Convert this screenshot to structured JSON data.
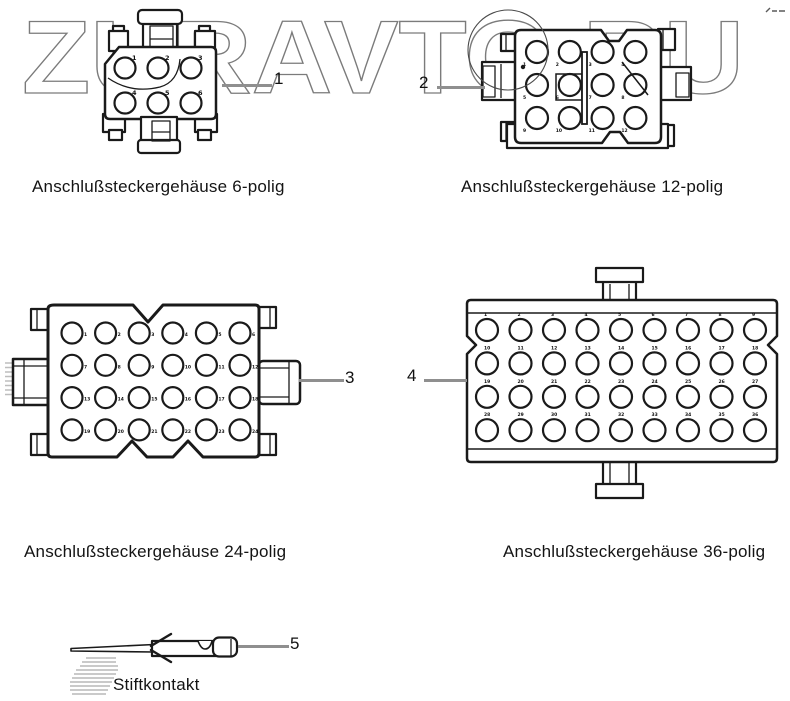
{
  "watermark": {
    "text": "ZURAVTO.RU"
  },
  "connectors": [
    {
      "callout": "1",
      "caption": "Anschlußsteckergehäuse 6-polig",
      "poles": 6,
      "rows": 2,
      "cols": 3,
      "pin_first": 1,
      "pin_last": 6
    },
    {
      "callout": "2",
      "caption": "Anschlußsteckergehäuse 12-polig",
      "poles": 12,
      "rows": 3,
      "cols": 4,
      "pin_first": 1,
      "pin_last": 12
    },
    {
      "callout": "3",
      "caption": "Anschlußsteckergehäuse 24-polig",
      "poles": 24,
      "rows": 4,
      "cols": 6,
      "pin_first": 1,
      "pin_last": 24
    },
    {
      "callout": "4",
      "caption": "Anschlußsteckergehäuse 36-polig",
      "poles": 36,
      "rows": 4,
      "cols": 9,
      "pin_first": 1,
      "pin_last": 36
    }
  ],
  "pin_contact": {
    "callout": "5",
    "caption": "Stiftkontakt"
  },
  "colors": {
    "line": "#1a1a1a",
    "watermark": "#7b7b7b",
    "leader": "#8f8f8f",
    "background": "#ffffff"
  }
}
